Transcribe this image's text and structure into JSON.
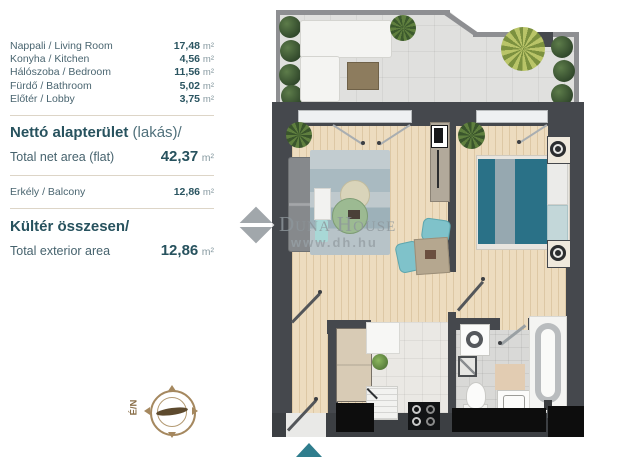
{
  "legend": {
    "rooms": [
      {
        "label": "Nappali / Living Room",
        "value": "17,48",
        "unit": "m²"
      },
      {
        "label": "Konyha / Kitchen",
        "value": "4,56",
        "unit": "m²"
      },
      {
        "label": "Hálószoba / Bedroom",
        "value": "11,56",
        "unit": "m²"
      },
      {
        "label": "Fürdő / Bathroom",
        "value": "5,02",
        "unit": "m²"
      },
      {
        "label": "Előtér / Lobby",
        "value": "3,75",
        "unit": "m²"
      }
    ],
    "net_title_hu": "Nettó alapterület",
    "net_title_paren": " (lakás)/",
    "net_label_en": "Total net area (flat)",
    "net_value": "42,37",
    "net_unit": "m²",
    "balcony_label": "Erkély / Balcony",
    "balcony_value": "12,86",
    "balcony_unit": "m²",
    "exterior_title": "Kültér összesen/",
    "exterior_label_en": "Total exterior area",
    "exterior_value": "12,86",
    "exterior_unit": "m²"
  },
  "watermark": {
    "name": "Duna House",
    "url": "www.dh.hu"
  },
  "compass": {
    "label": "É/N"
  },
  "colors": {
    "accent_teal": "#2f7d8d",
    "wall": "#45484d",
    "wood_floor": "#eddcbf",
    "bed_teal": "#2a7187",
    "text_dark": "#27525e",
    "watermark_gray": "#8d969b",
    "compass_tan": "#a5885f"
  }
}
